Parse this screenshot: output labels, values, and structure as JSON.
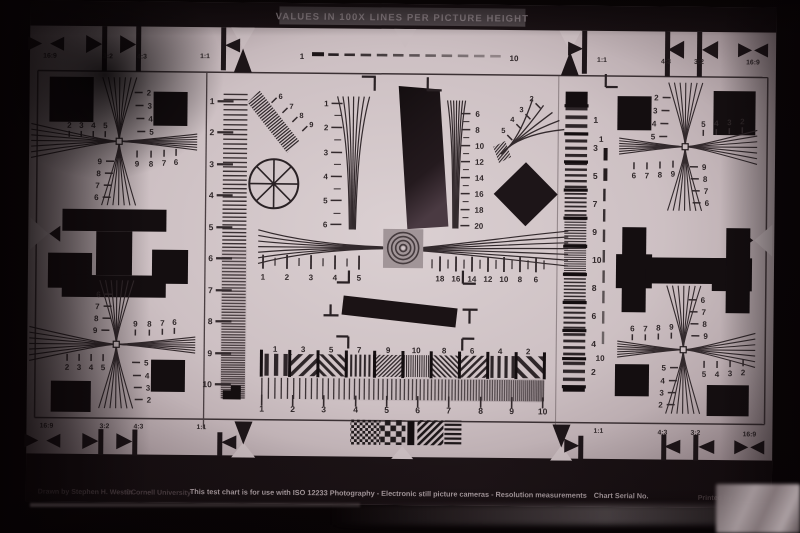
{
  "banner": {
    "title": "VALUES IN 100X LINES PER PICTURE HEIGHT"
  },
  "footer": {
    "credit": "Drawn by Stephen H. Westin",
    "copyright": "©Cornell University",
    "description": "This test chart is for use with ISO 12233 Photography - Electronic still picture cameras - Resolution measurements",
    "serial_label": "Chart Serial No.",
    "printed_label": "Printed by"
  },
  "aspect_top": [
    "16:9",
    "3:2",
    "4:3",
    "1:1",
    "1:1",
    "4:3",
    "3:2",
    "16:9"
  ],
  "aspect_bottom": [
    "16:9",
    "3:2",
    "4:3",
    "1:1",
    "1:1",
    "4:3",
    "3:2",
    "16:9"
  ],
  "top_dash_scale": [
    "1",
    "10"
  ],
  "right_dash_scale": [
    "1",
    "10"
  ],
  "left_ruler": [
    "1",
    "2",
    "3",
    "4",
    "5",
    "6",
    "7",
    "8",
    "9",
    "10"
  ],
  "right_strip": [
    "1",
    "3",
    "5",
    "7",
    "9",
    "10",
    "8",
    "6",
    "4",
    "2"
  ],
  "center": {
    "left_wedge": [
      "1",
      "2",
      "3",
      "4",
      "5",
      "6"
    ],
    "right_wedge": [
      "6",
      "8",
      "10",
      "12",
      "14",
      "16",
      "18",
      "20"
    ],
    "upper_diagonal": [
      "6",
      "7",
      "8",
      "9"
    ],
    "right_diagonal": [
      "2",
      "3",
      "4",
      "5"
    ],
    "h_left_scale": [
      "1",
      "2",
      "3",
      "4",
      "5"
    ],
    "h_right_scale": [
      "18",
      "16",
      "14",
      "12",
      "10",
      "8",
      "6"
    ],
    "band_labels": [
      "1",
      "3",
      "5",
      "7",
      "9",
      "10",
      "8",
      "6",
      "4",
      "2"
    ],
    "band_scale": [
      "1",
      "2",
      "3",
      "4",
      "5",
      "6",
      "7",
      "8",
      "9",
      "10"
    ]
  },
  "crosses": {
    "top_left": {
      "v_upper": [
        "2",
        "3",
        "4",
        "5"
      ],
      "v_lower": [
        "9",
        "8",
        "7",
        "6"
      ],
      "h_upper": [
        "2",
        "3",
        "4",
        "5"
      ],
      "h_lower": [
        "9",
        "8",
        "7",
        "6"
      ]
    },
    "top_right": {
      "v_upper": [
        "2",
        "3",
        "4",
        "5"
      ],
      "v_lower": [
        "9",
        "8",
        "7",
        "6"
      ],
      "h_upper": [
        "5",
        "4",
        "3",
        "2"
      ],
      "h_lower": [
        "6",
        "7",
        "8",
        "9"
      ]
    },
    "bottom_left": {
      "v_upper": [
        "6",
        "7",
        "8",
        "9"
      ],
      "v_lower": [
        "5",
        "4",
        "3",
        "2"
      ],
      "h_upper": [
        "9",
        "8",
        "7",
        "6"
      ],
      "h_lower": [
        "2",
        "3",
        "4",
        "5"
      ]
    },
    "bottom_right": {
      "v_upper": [
        "6",
        "7",
        "8",
        "9"
      ],
      "v_lower": [
        "5",
        "4",
        "3",
        "2"
      ],
      "h_upper": [
        "6",
        "7",
        "8",
        "9"
      ],
      "h_lower": [
        "5",
        "4",
        "3",
        "2"
      ]
    }
  },
  "colors": {
    "paper_center": "#dbd0d2",
    "paper_edge": "#7e6d72",
    "ink": "#2f2729",
    "print_black": "#140e10",
    "background": "#070304"
  }
}
